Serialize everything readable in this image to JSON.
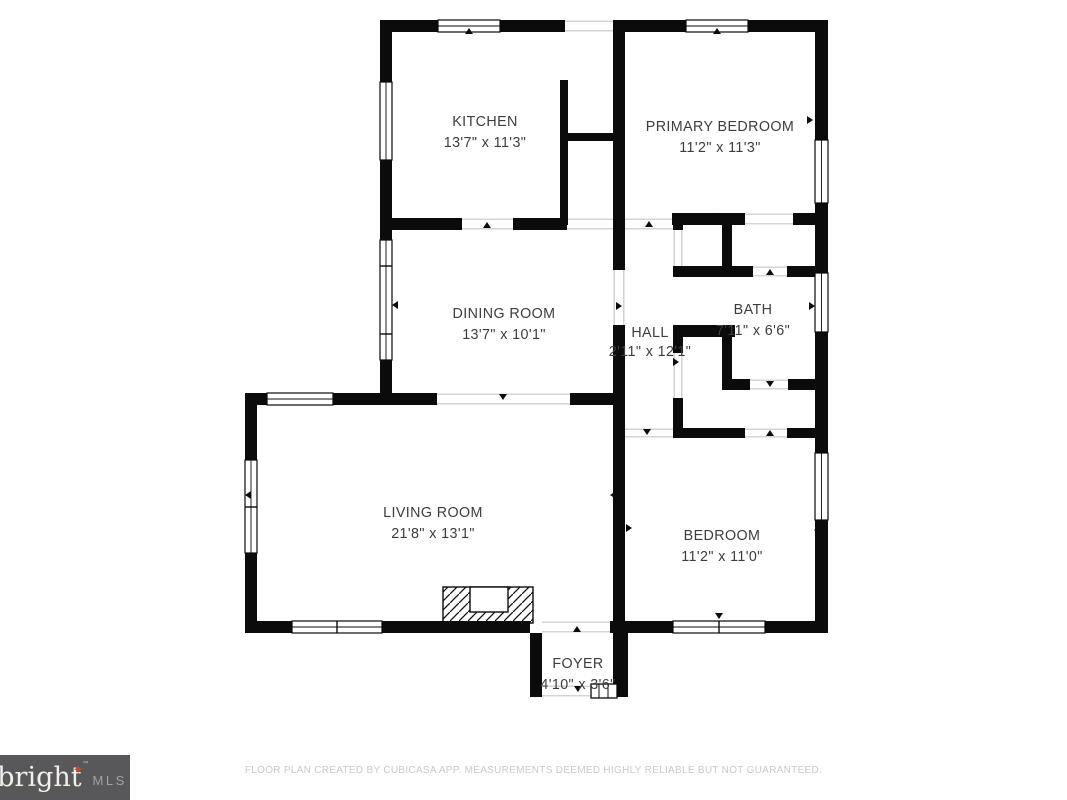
{
  "page": {
    "width": 1067,
    "height": 800,
    "background": "#ffffff"
  },
  "floorplan": {
    "wall_color": "#0b0b0b",
    "opening_color": "#c6c6c6",
    "label_color": "#3d3d3d",
    "rooms": [
      {
        "id": "kitchen",
        "name": "KITCHEN",
        "dims": "13'7\" x 11'3\"",
        "cx": 485,
        "name_y": 126,
        "dims_y": 147
      },
      {
        "id": "primary-bedroom",
        "name": "PRIMARY BEDROOM",
        "dims": "11'2\" x 11'3\"",
        "cx": 720,
        "name_y": 131,
        "dims_y": 152
      },
      {
        "id": "dining-room",
        "name": "DINING ROOM",
        "dims": "13'7\" x 10'1\"",
        "cx": 504,
        "name_y": 318,
        "dims_y": 339
      },
      {
        "id": "hall",
        "name": "HALL",
        "dims": "2'11\" x 12'1\"",
        "cx": 650,
        "name_y": 337,
        "dims_y": 356
      },
      {
        "id": "bath",
        "name": "BATH",
        "dims": "7'11\" x 6'6\"",
        "cx": 753,
        "name_y": 314,
        "dims_y": 335
      },
      {
        "id": "living-room",
        "name": "LIVING ROOM",
        "dims": "21'8\" x 13'1\"",
        "cx": 433,
        "name_y": 517,
        "dims_y": 538
      },
      {
        "id": "bedroom",
        "name": "BEDROOM",
        "dims": "11'2\" x 11'0\"",
        "cx": 722,
        "name_y": 540,
        "dims_y": 561
      },
      {
        "id": "foyer",
        "name": "FOYER",
        "dims": "4'10\" x 3'6\"",
        "cx": 578,
        "name_y": 668,
        "dims_y": 689
      }
    ],
    "walls": [
      {
        "x": 380,
        "y": 20,
        "w": 58,
        "h": 12
      },
      {
        "x": 500,
        "y": 20,
        "w": 65,
        "h": 12
      },
      {
        "x": 613,
        "y": 20,
        "w": 73,
        "h": 12
      },
      {
        "x": 748,
        "y": 20,
        "w": 80,
        "h": 12
      },
      {
        "x": 380,
        "y": 20,
        "w": 12,
        "h": 62
      },
      {
        "x": 380,
        "y": 160,
        "w": 12,
        "h": 80
      },
      {
        "x": 380,
        "y": 360,
        "w": 12,
        "h": 45
      },
      {
        "x": 380,
        "y": 218,
        "w": 82,
        "h": 12
      },
      {
        "x": 513,
        "y": 218,
        "w": 54,
        "h": 12
      },
      {
        "x": 560,
        "y": 80,
        "w": 8,
        "h": 145
      },
      {
        "x": 565,
        "y": 133,
        "w": 58,
        "h": 8
      },
      {
        "x": 613,
        "y": 20,
        "w": 12,
        "h": 250
      },
      {
        "x": 613,
        "y": 325,
        "w": 12,
        "h": 300
      },
      {
        "x": 672,
        "y": 213,
        "w": 73,
        "h": 12
      },
      {
        "x": 793,
        "y": 213,
        "w": 35,
        "h": 12
      },
      {
        "x": 722,
        "y": 213,
        "w": 10,
        "h": 55
      },
      {
        "x": 673,
        "y": 266,
        "w": 80,
        "h": 11
      },
      {
        "x": 787,
        "y": 266,
        "w": 41,
        "h": 11
      },
      {
        "x": 673,
        "y": 218,
        "w": 10,
        "h": 12
      },
      {
        "x": 673,
        "y": 325,
        "w": 62,
        "h": 12
      },
      {
        "x": 673,
        "y": 325,
        "w": 10,
        "h": 28
      },
      {
        "x": 722,
        "y": 325,
        "w": 10,
        "h": 64
      },
      {
        "x": 722,
        "y": 379,
        "w": 28,
        "h": 11
      },
      {
        "x": 788,
        "y": 379,
        "w": 27,
        "h": 11
      },
      {
        "x": 673,
        "y": 398,
        "w": 10,
        "h": 40
      },
      {
        "x": 673,
        "y": 428,
        "w": 72,
        "h": 10
      },
      {
        "x": 787,
        "y": 428,
        "w": 41,
        "h": 10
      },
      {
        "x": 815,
        "y": 20,
        "w": 13,
        "h": 120
      },
      {
        "x": 815,
        "y": 203,
        "w": 13,
        "h": 70
      },
      {
        "x": 815,
        "y": 332,
        "w": 13,
        "h": 121
      },
      {
        "x": 815,
        "y": 520,
        "w": 13,
        "h": 113
      },
      {
        "x": 245,
        "y": 393,
        "w": 22,
        "h": 12
      },
      {
        "x": 333,
        "y": 393,
        "w": 104,
        "h": 12
      },
      {
        "x": 570,
        "y": 393,
        "w": 55,
        "h": 12
      },
      {
        "x": 245,
        "y": 393,
        "w": 12,
        "h": 67
      },
      {
        "x": 245,
        "y": 553,
        "w": 12,
        "h": 80
      },
      {
        "x": 245,
        "y": 621,
        "w": 47,
        "h": 12
      },
      {
        "x": 382,
        "y": 621,
        "w": 148,
        "h": 12
      },
      {
        "x": 610,
        "y": 621,
        "w": 18,
        "h": 12
      },
      {
        "x": 628,
        "y": 621,
        "w": 45,
        "h": 12
      },
      {
        "x": 765,
        "y": 621,
        "w": 63,
        "h": 12
      },
      {
        "x": 530,
        "y": 633,
        "w": 12,
        "h": 64
      },
      {
        "x": 613,
        "y": 633,
        "w": 15,
        "h": 64
      },
      {
        "x": 530,
        "y": 685,
        "w": 12,
        "h": 12
      }
    ],
    "windows": [
      {
        "x": 438,
        "y": 20,
        "w": 62,
        "h": 12,
        "divs": []
      },
      {
        "x": 686,
        "y": 20,
        "w": 62,
        "h": 12,
        "divs": []
      },
      {
        "x": 380,
        "y": 82,
        "w": 12,
        "h": 78,
        "divs": []
      },
      {
        "x": 380,
        "y": 240,
        "w": 12,
        "h": 120,
        "divs": [
          266,
          334
        ]
      },
      {
        "x": 267,
        "y": 393,
        "w": 66,
        "h": 12,
        "divs": []
      },
      {
        "x": 245,
        "y": 460,
        "w": 12,
        "h": 93,
        "divs": [
          507
        ]
      },
      {
        "x": 292,
        "y": 621,
        "w": 90,
        "h": 12,
        "divs": [
          337
        ]
      },
      {
        "x": 673,
        "y": 621,
        "w": 92,
        "h": 12,
        "divs": [
          719
        ]
      },
      {
        "x": 815,
        "y": 453,
        "w": 13,
        "h": 67,
        "divs": []
      },
      {
        "x": 815,
        "y": 273,
        "w": 13,
        "h": 59,
        "divs": []
      },
      {
        "x": 815,
        "y": 140,
        "w": 13,
        "h": 63,
        "divs": []
      }
    ],
    "openings": [
      {
        "x": 565,
        "y": 20,
        "w": 48,
        "h": 12
      },
      {
        "x": 462,
        "y": 218,
        "w": 51,
        "h": 12
      },
      {
        "x": 567,
        "y": 218,
        "w": 46,
        "h": 12
      },
      {
        "x": 625,
        "y": 218,
        "w": 48,
        "h": 12
      },
      {
        "x": 745,
        "y": 213,
        "w": 48,
        "h": 12
      },
      {
        "x": 673,
        "y": 230,
        "w": 10,
        "h": 36
      },
      {
        "x": 613,
        "y": 270,
        "w": 12,
        "h": 55
      },
      {
        "x": 753,
        "y": 266,
        "w": 34,
        "h": 11
      },
      {
        "x": 673,
        "y": 353,
        "w": 10,
        "h": 45
      },
      {
        "x": 750,
        "y": 379,
        "w": 38,
        "h": 11
      },
      {
        "x": 625,
        "y": 428,
        "w": 48,
        "h": 10
      },
      {
        "x": 745,
        "y": 428,
        "w": 42,
        "h": 10
      },
      {
        "x": 437,
        "y": 393,
        "w": 133,
        "h": 12
      },
      {
        "x": 542,
        "y": 621,
        "w": 68,
        "h": 12
      },
      {
        "x": 542,
        "y": 685,
        "w": 49,
        "h": 12
      }
    ],
    "markers": [
      {
        "x": 469,
        "y": 31,
        "d": "up"
      },
      {
        "x": 717,
        "y": 31,
        "d": "up"
      },
      {
        "x": 388,
        "y": 53,
        "d": "left"
      },
      {
        "x": 620,
        "y": 53,
        "d": "right"
      },
      {
        "x": 810,
        "y": 120,
        "d": "right"
      },
      {
        "x": 487,
        "y": 225,
        "d": "up"
      },
      {
        "x": 649,
        "y": 224,
        "d": "up"
      },
      {
        "x": 716,
        "y": 217,
        "d": "down"
      },
      {
        "x": 770,
        "y": 272,
        "d": "up"
      },
      {
        "x": 395,
        "y": 305,
        "d": "left"
      },
      {
        "x": 619,
        "y": 306,
        "d": "right"
      },
      {
        "x": 622,
        "y": 362,
        "d": "left"
      },
      {
        "x": 676,
        "y": 362,
        "d": "right"
      },
      {
        "x": 812,
        "y": 306,
        "d": "right"
      },
      {
        "x": 770,
        "y": 384,
        "d": "down"
      },
      {
        "x": 503,
        "y": 397,
        "d": "down"
      },
      {
        "x": 390,
        "y": 400,
        "d": "up"
      },
      {
        "x": 248,
        "y": 495,
        "d": "left"
      },
      {
        "x": 613,
        "y": 495,
        "d": "left"
      },
      {
        "x": 629,
        "y": 528,
        "d": "right"
      },
      {
        "x": 817,
        "y": 530,
        "d": "left"
      },
      {
        "x": 387,
        "y": 627,
        "d": "down"
      },
      {
        "x": 719,
        "y": 616,
        "d": "down"
      },
      {
        "x": 647,
        "y": 432,
        "d": "down"
      },
      {
        "x": 770,
        "y": 433,
        "d": "up"
      },
      {
        "x": 577,
        "y": 629,
        "d": "up"
      },
      {
        "x": 578,
        "y": 689,
        "d": "down"
      }
    ],
    "fireplace": {
      "x": 443,
      "y": 587,
      "w": 90,
      "h": 36,
      "notch": {
        "x": 470,
        "y": 587,
        "w": 38,
        "h": 25
      }
    },
    "entry_steps": {
      "x": 591,
      "y": 684,
      "w": 26,
      "h": 14
    }
  },
  "footer": {
    "logo": {
      "brand": "bright",
      "star": "✦",
      "tm": "™",
      "suffix": "MLS",
      "bg": "#58585a",
      "brand_color": "#f2efe9",
      "star_color": "#c14b2e",
      "tm_color": "#bdbdbd",
      "suffix_color": "#a2a2a2"
    },
    "disclaimer": "FLOOR PLAN CREATED BY CUBICASA APP. MEASUREMENTS DEEMED HIGHLY RELIABLE BUT NOT GUARANTEED.",
    "disclaimer_color": "#c9c9c9"
  }
}
